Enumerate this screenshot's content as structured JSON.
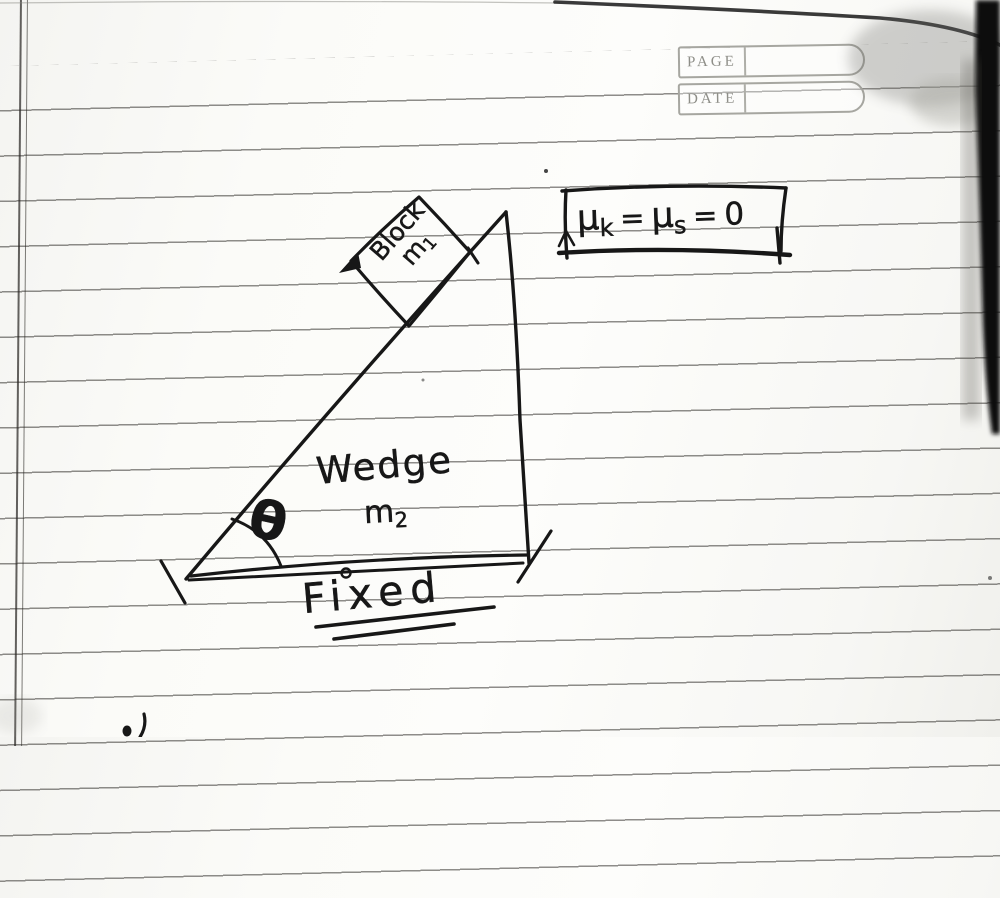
{
  "header": {
    "page_label": "PAGE",
    "date_label": "DATE"
  },
  "friction_note": {
    "mu1": "μ",
    "kinetic_sub": "k",
    "equals1": "=",
    "mu2": "μ",
    "static_sub": "s",
    "equals2": "=",
    "value": "0"
  },
  "block": {
    "label": "Block",
    "mass_symbol": "m",
    "mass_subscript": "1"
  },
  "wedge": {
    "label": "Wedge",
    "mass_symbol": "m",
    "mass_subscript": "2"
  },
  "incline_angle": {
    "symbol": "θ"
  },
  "ground": {
    "label": "Fixed"
  },
  "colors": {
    "ink": "#171717",
    "rule": "#35332f",
    "printgray": "#8e8e88",
    "paper": "#fbfbf8"
  }
}
